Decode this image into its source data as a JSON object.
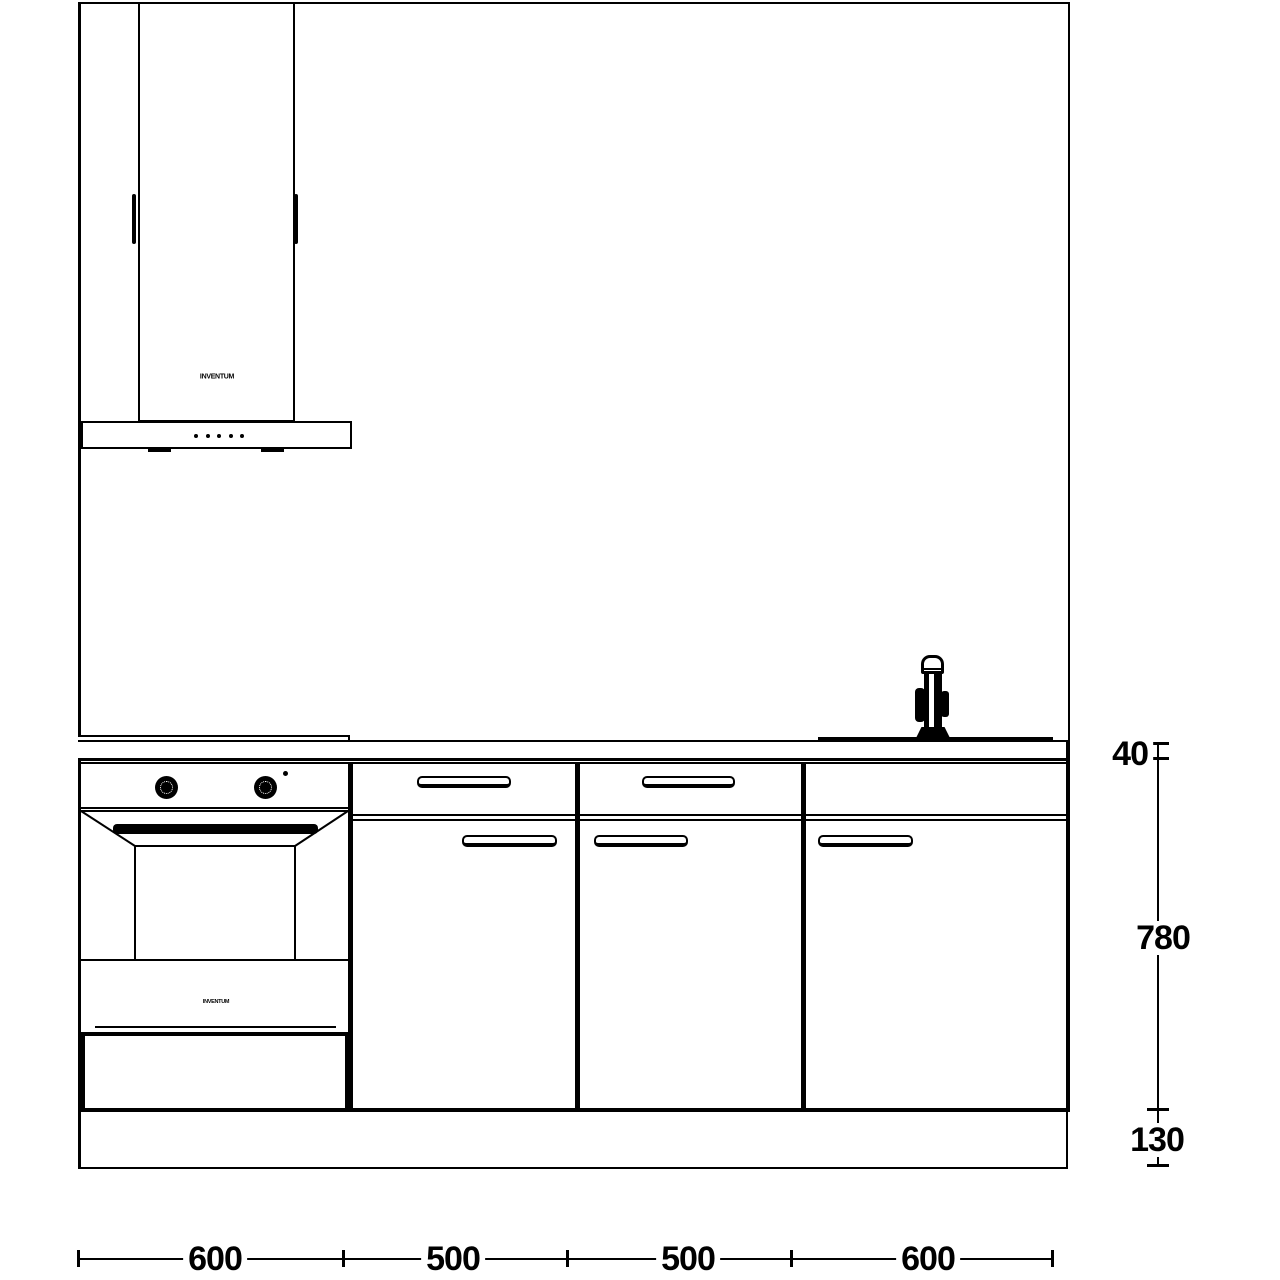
{
  "drawing": {
    "colors": {
      "line": "#000000",
      "background": "#ffffff"
    },
    "hood": {
      "brand_text": "INVENTUM"
    },
    "oven": {
      "brand_text": "INVENTUM"
    },
    "dims_right": [
      {
        "label": "40"
      },
      {
        "label": "780"
      },
      {
        "label": "130"
      }
    ],
    "dims_bottom": [
      {
        "label": "600"
      },
      {
        "label": "500"
      },
      {
        "label": "500"
      },
      {
        "label": "600"
      }
    ]
  }
}
